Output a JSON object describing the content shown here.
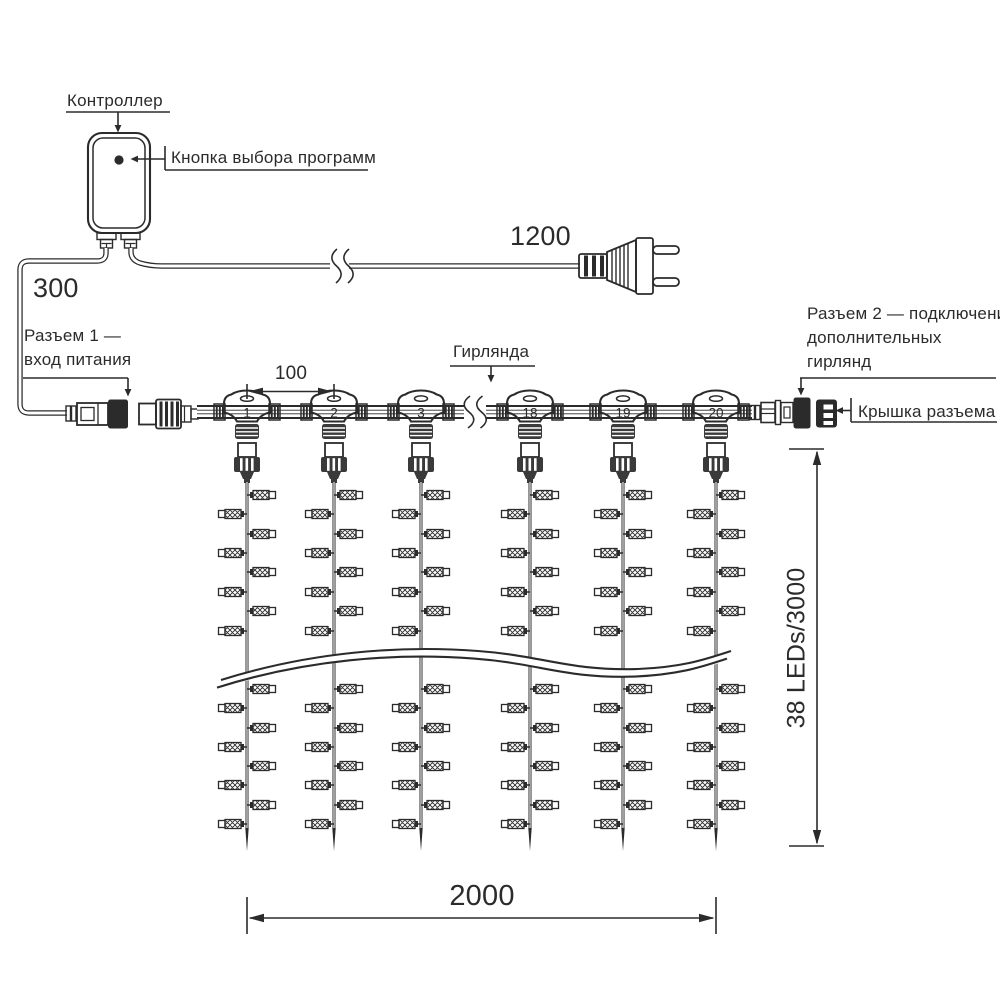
{
  "labels": {
    "controller": "Контроллер",
    "program_button": "Кнопка выбора программ",
    "garland": "Гирлянда",
    "connector1_line1": "Разъем 1 —",
    "connector1_line2": "вход питания",
    "connector2_line1": "Разъем 2 — подключение",
    "connector2_line2": "дополнительных",
    "connector2_line3": "гирлянд",
    "cap": "Крышка разъема"
  },
  "dimensions": {
    "left_cable": "300",
    "power_cable": "1200",
    "drop_spacing": "100",
    "curtain_width": "2000",
    "curtain_height": "38 LEDs/3000"
  },
  "curtain": {
    "drops": [
      {
        "label": "1",
        "x": 247
      },
      {
        "label": "2",
        "x": 334
      },
      {
        "label": "3",
        "x": 421
      },
      {
        "label": "18",
        "x": 530
      },
      {
        "label": "19",
        "x": 623
      },
      {
        "label": "20",
        "x": 716
      }
    ],
    "lamp_rows": [
      {
        "y": 495,
        "side": "right"
      },
      {
        "y": 514,
        "side": "left"
      },
      {
        "y": 534,
        "side": "right"
      },
      {
        "y": 553,
        "side": "left"
      },
      {
        "y": 572,
        "side": "right"
      },
      {
        "y": 592,
        "side": "left"
      },
      {
        "y": 611,
        "side": "right"
      },
      {
        "y": 631,
        "side": "left"
      },
      {
        "y": 689,
        "side": "right"
      },
      {
        "y": 708,
        "side": "left"
      },
      {
        "y": 728,
        "side": "right"
      },
      {
        "y": 747,
        "side": "left"
      },
      {
        "y": 766,
        "side": "right"
      },
      {
        "y": 785,
        "side": "left"
      },
      {
        "y": 805,
        "side": "right"
      },
      {
        "y": 824,
        "side": "left"
      }
    ],
    "string_top": 482,
    "string_bottom": 851
  },
  "colors": {
    "ink": "#2b2b2b",
    "background": "#ffffff"
  }
}
